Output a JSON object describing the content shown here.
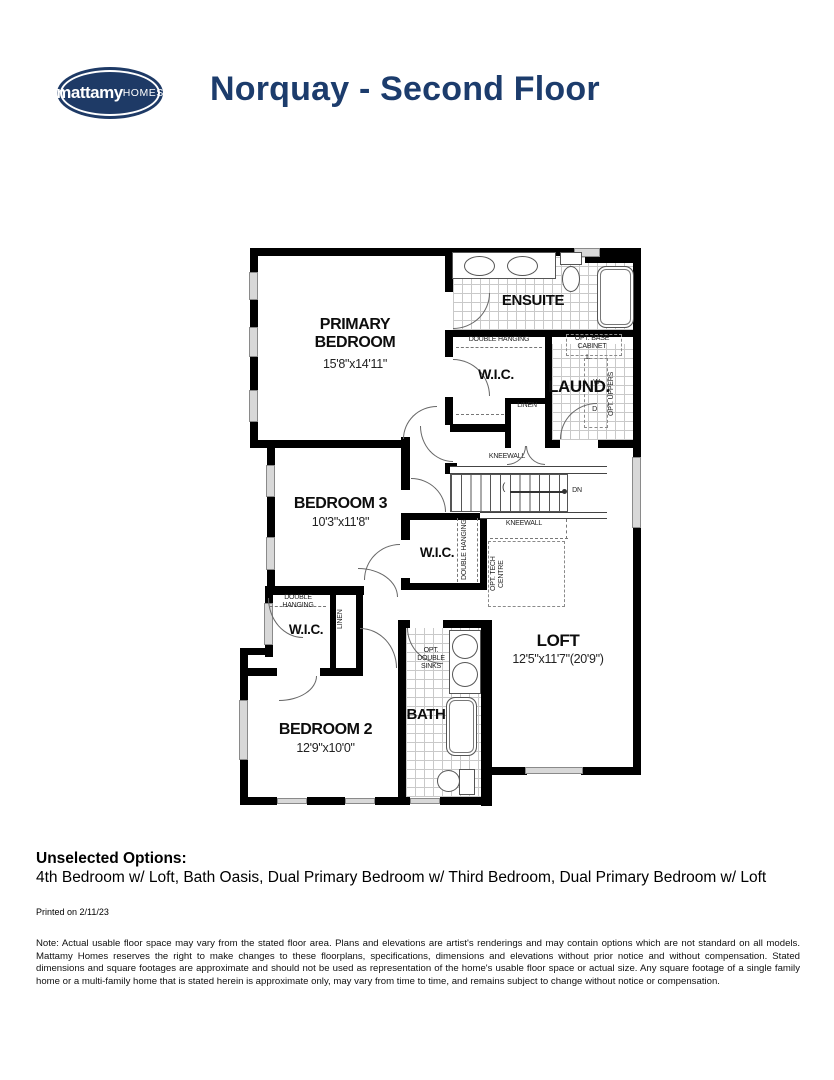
{
  "header": {
    "logo_primary": "mattamy",
    "logo_secondary": "HOMES",
    "title": "Norquay - Second Floor"
  },
  "colors": {
    "brand_navy": "#1e3a66",
    "title_navy": "#1c3c6c",
    "wall_black": "#000000"
  },
  "floorplan": {
    "rooms": {
      "primary": {
        "name": "PRIMARY BEDROOM",
        "dims": "15'8\"x14'11\""
      },
      "ensuite": {
        "name": "ENSUITE"
      },
      "wic_primary": {
        "name": "W.I.C."
      },
      "laundry": {
        "name": "LAUND."
      },
      "bedroom3": {
        "name": "BEDROOM 3",
        "dims": "10'3\"x11'8\""
      },
      "wic_bedroom3": {
        "name": "W.I.C."
      },
      "loft": {
        "name": "LOFT",
        "dims": "12'5\"x11'7\"(20'9\")"
      },
      "wic_bedroom2": {
        "name": "W.I.C."
      },
      "bedroom2": {
        "name": "BEDROOM 2",
        "dims": "12'9\"x10'0\""
      },
      "bath": {
        "name": "BATH"
      }
    },
    "labels": {
      "double_hanging": "DOUBLE HANGING",
      "linen": "LINEN",
      "linen_short": "L",
      "kneewall": "KNEEWALL",
      "dn": "DN",
      "opt_base_cabinet": "OPT. BASE CABINET",
      "washer": "W",
      "dryer": "D",
      "opt_uppers": "OPT. UPPERS",
      "opt_tech_centre": "OPT. TECH CENTRE",
      "opt_double_sinks": "OPT. DOUBLE SINKS"
    }
  },
  "footer": {
    "unselected_heading": "Unselected Options:",
    "unselected_options": "4th Bedroom w/ Loft, Bath Oasis, Dual Primary Bedroom w/ Third Bedroom, Dual Primary Bedroom w/ Loft",
    "printed": "Printed on 2/11/23",
    "note": "Note: Actual usable floor space may vary from the stated floor area. Plans and elevations are artist's renderings and may contain options which are not standard on all models. Mattamy Homes reserves the right to make changes to these floorplans, specifications, dimensions and elevations without prior notice and without compensation. Stated dimensions and square footages are approximate and should not be used as representation of the home's usable floor space or actual size. Any square footage of a single family home or a multi-family home that is stated herein is approximate only, may vary from time to time, and remains subject to change without notice or compensation."
  }
}
